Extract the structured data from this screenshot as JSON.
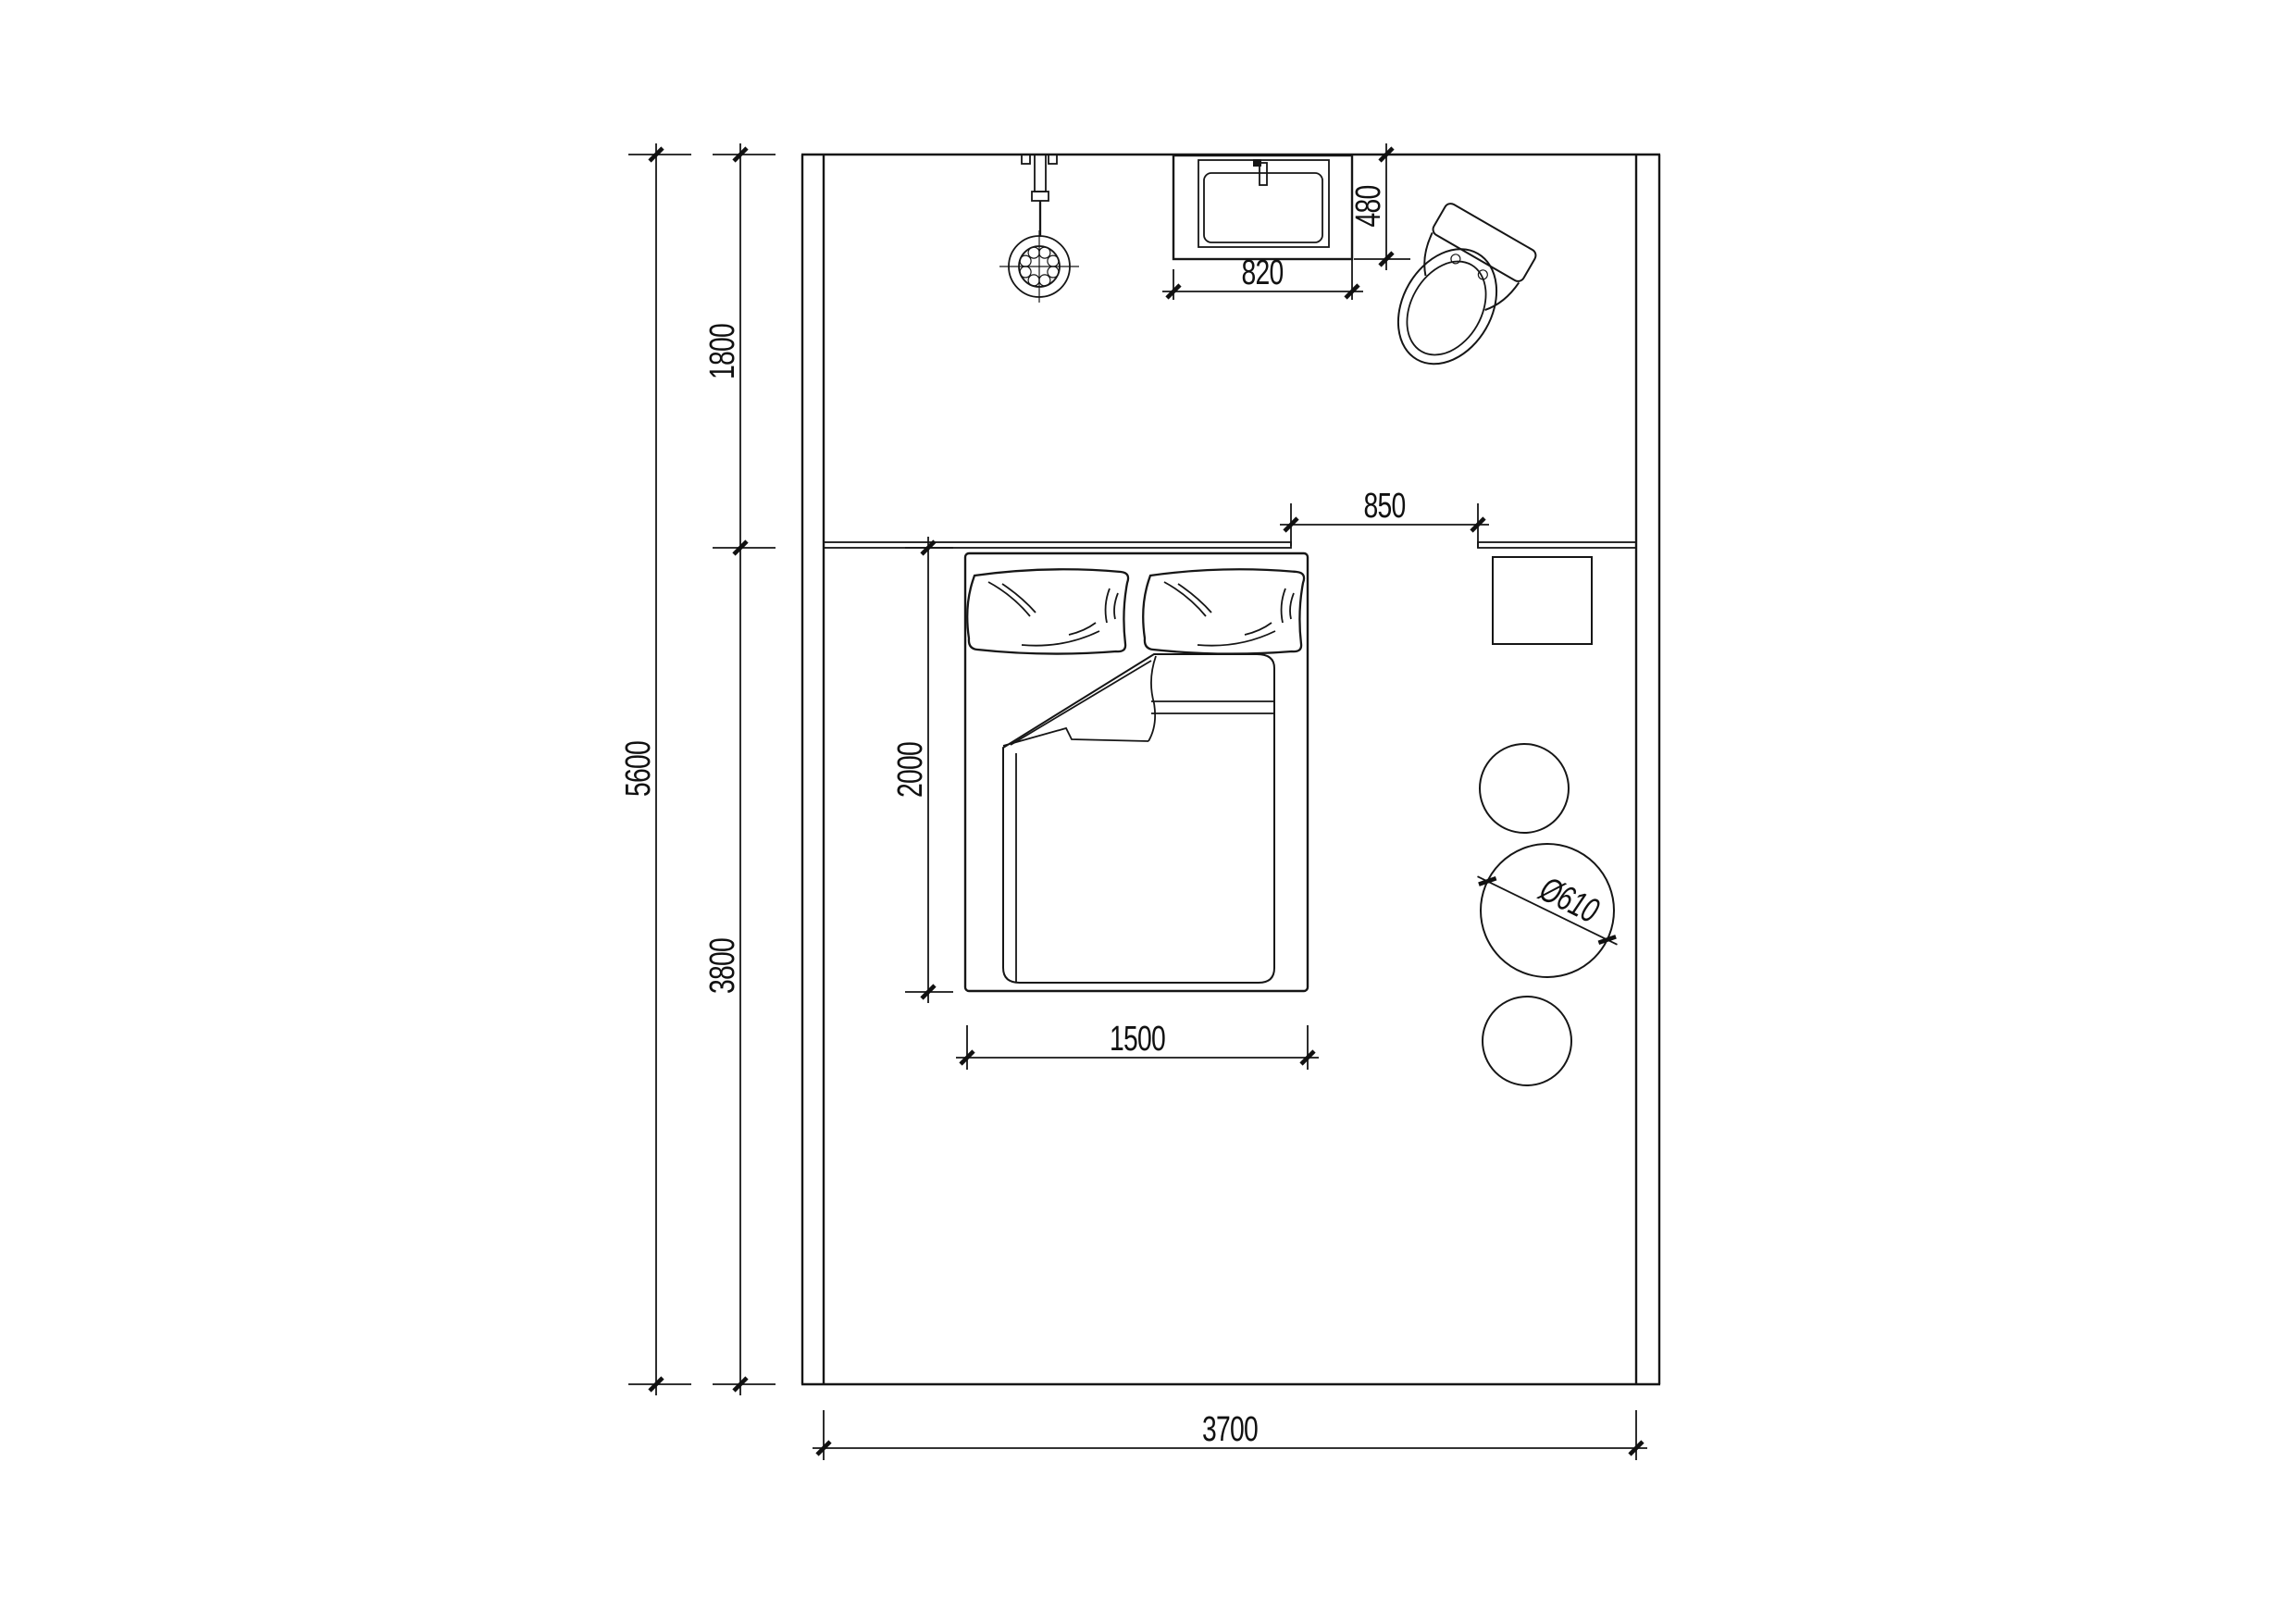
{
  "title": "bedroom floor plan drawing",
  "colors": {
    "line": "#161616",
    "background": "#ffffff",
    "text": "#111111"
  },
  "dims": {
    "d5600": "5600",
    "d1800": "1800",
    "d3800": "3800",
    "d3700": "3700",
    "d820": "820",
    "d480": "480",
    "d850": "850",
    "d2000": "2000",
    "d1500": "1500",
    "d610": "Ø610"
  }
}
